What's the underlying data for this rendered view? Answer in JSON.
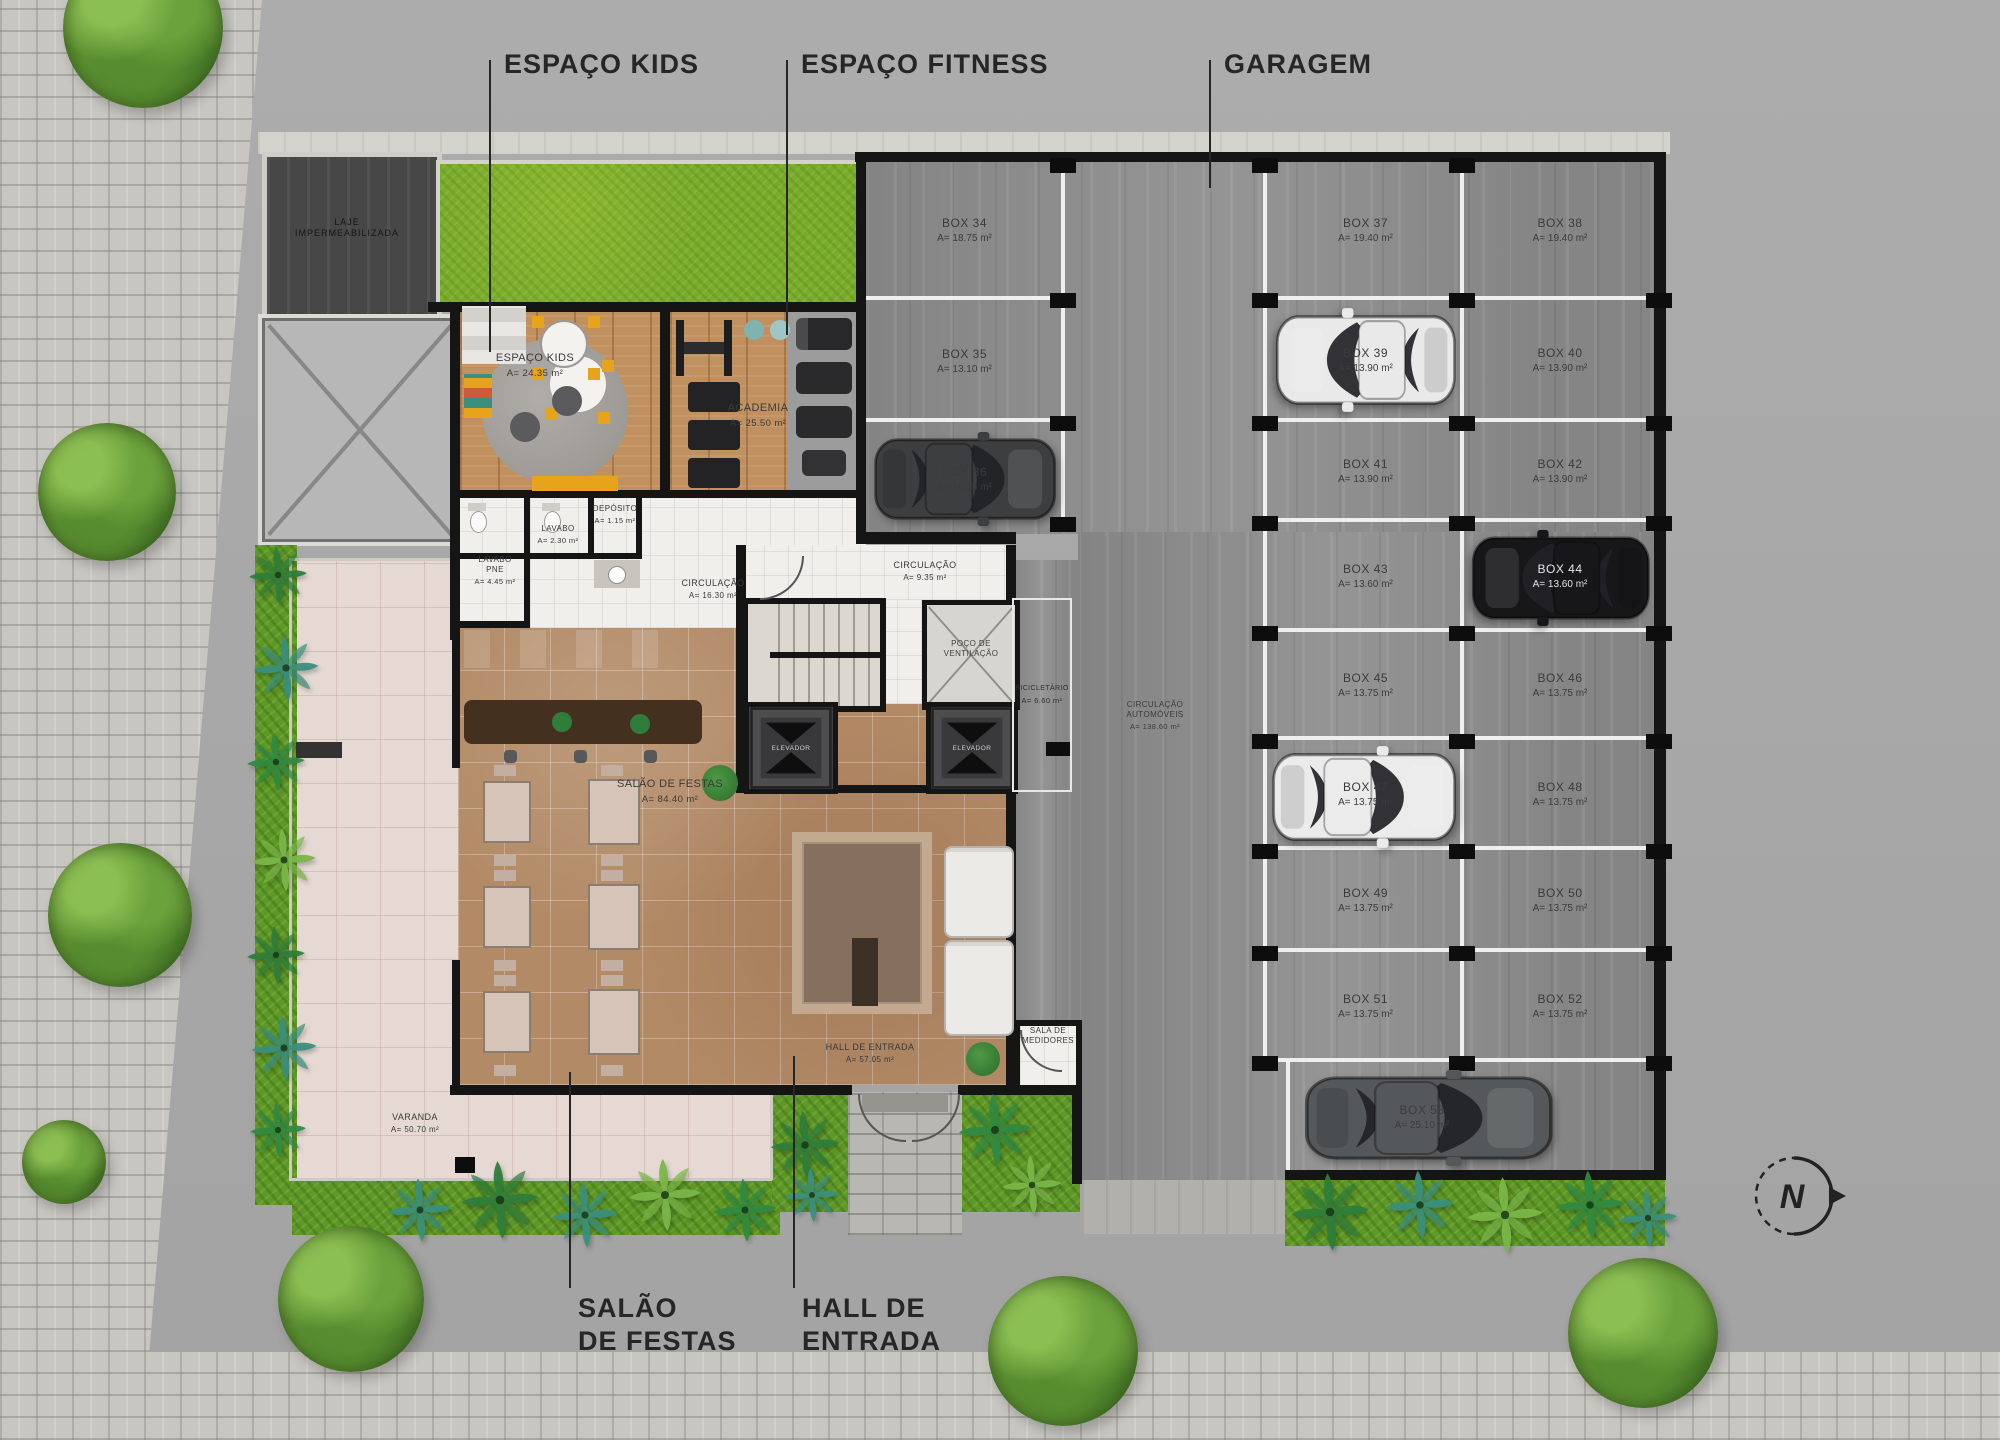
{
  "plan": {
    "north": "N",
    "callouts": {
      "kids": "ESPAÇO KIDS",
      "fitness": "ESPAÇO FITNESS",
      "garage": "GARAGEM",
      "salao_l1": "SALÃO",
      "salao_l2": "DE FESTAS",
      "hall_l1": "HALL DE",
      "hall_l2": "ENTRADA"
    },
    "rooms": {
      "laje": {
        "l1": "LAJE",
        "l2": "IMPERMEABILIZADA"
      },
      "kids": {
        "name": "ESPAÇO KIDS",
        "area": "A= 24.35 m²"
      },
      "academia": {
        "name": "ACADEMIA",
        "area": "A= 25.50 m²"
      },
      "lavabo_pne": {
        "l1": "LAVABO",
        "l2": "PNE",
        "area": "A= 4.45 m²"
      },
      "lavabo": {
        "name": "LAVABO",
        "area": "A= 2.30 m²"
      },
      "deposito": {
        "name": "DEPÓSITO",
        "area": "A= 1.15 m²"
      },
      "circ_social": {
        "name": "CIRCULAÇÃO",
        "area": "A= 16.30 m²"
      },
      "circ_core": {
        "name": "CIRCULAÇÃO",
        "area": "A= 9.35 m²"
      },
      "poco": {
        "l1": "POÇO DE",
        "l2": "VENTILAÇÃO"
      },
      "elevador": {
        "name": "ELEVADOR"
      },
      "bicicletario": {
        "name": "BICICLETÁRIO",
        "area": "A= 6.60 m²"
      },
      "salao": {
        "name": "SALÃO DE FESTAS",
        "area": "A= 84.40 m²"
      },
      "hall": {
        "name": "HALL DE ENTRADA",
        "area": "A= 57.05 m²"
      },
      "medidores": {
        "name": "SALA DE MEDIDORES"
      },
      "varanda": {
        "name": "VARANDA",
        "area": "A= 50.70 m²"
      },
      "circ_autos": {
        "l1": "CIRCULAÇÃO",
        "l2": "AUTOMÓVEIS",
        "area": "A= 138.60 m²"
      }
    },
    "boxes": [
      {
        "name": "BOX 34",
        "area": "A= 18.75 m²"
      },
      {
        "name": "BOX 35",
        "area": "A= 13.10 m²"
      },
      {
        "name": "BOX 36",
        "area": "A= 16.35 m²"
      },
      {
        "name": "BOX 37",
        "area": "A= 19.40 m²"
      },
      {
        "name": "BOX 38",
        "area": "A= 19.40 m²"
      },
      {
        "name": "BOX 39",
        "area": "A= 13.90 m²"
      },
      {
        "name": "BOX 40",
        "area": "A= 13.90 m²"
      },
      {
        "name": "BOX 41",
        "area": "A= 13.90 m²"
      },
      {
        "name": "BOX 42",
        "area": "A= 13.90 m²"
      },
      {
        "name": "BOX 43",
        "area": "A= 13.60 m²"
      },
      {
        "name": "BOX 44",
        "area": "A= 13.60 m²"
      },
      {
        "name": "BOX 45",
        "area": "A= 13.75 m²"
      },
      {
        "name": "BOX 46",
        "area": "A= 13.75 m²"
      },
      {
        "name": "BOX 47",
        "area": "A= 13.75 m²"
      },
      {
        "name": "BOX 48",
        "area": "A= 13.75 m²"
      },
      {
        "name": "BOX 49",
        "area": "A= 13.75 m²"
      },
      {
        "name": "BOX 50",
        "area": "A= 13.75 m²"
      },
      {
        "name": "BOX 51",
        "area": "A= 13.75 m²"
      },
      {
        "name": "BOX 52",
        "area": "A= 13.75 m²"
      },
      {
        "name": "BOX 53",
        "area": "A= 25.10 m²"
      }
    ],
    "colors": {
      "grass": "#79ab2d",
      "garden": "#5f9828",
      "concrete": "#8f8f8f",
      "wood": "#c0905f",
      "marble": "#b28a66",
      "white_tile": "#f1efeb",
      "varanda": "#e6d9d3",
      "wall": "#151515",
      "annotation": "#262626"
    }
  }
}
